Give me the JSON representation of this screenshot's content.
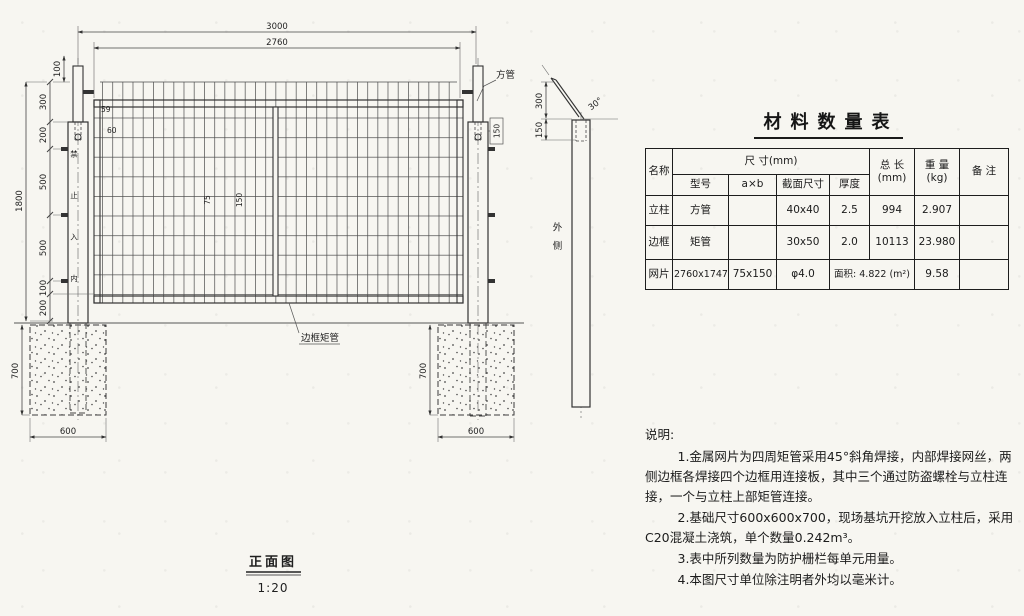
{
  "drawing": {
    "front_view": {
      "title": "正面图",
      "scale": "1:20"
    },
    "dims": {
      "total_width": "3000",
      "panel_width": "2760",
      "top_offset": "100",
      "left_chain": [
        "300",
        "200",
        "500",
        "500",
        "100",
        "200"
      ],
      "post_height": "1800",
      "footing_depth": "700",
      "footing_width": "600",
      "offset_a": "59",
      "offset_b": "60",
      "mesh_cell_w": "75",
      "mesh_cell_h": "150",
      "plate_height": "150",
      "side_arm_length": "300",
      "side_insert_depth": "150",
      "side_angle": "30°"
    },
    "labels": {
      "square_tube": "方管",
      "frame_tube": "边框矩管",
      "outer_side": "外侧",
      "post_marking": "禁止入内"
    }
  },
  "table": {
    "title": "材料数量表",
    "header": {
      "name": "名称",
      "size_group": "尺 寸(mm)",
      "model": "型号",
      "axb": "a×b",
      "section": "截面尺寸",
      "thickness": "厚度",
      "total_1": "总 长",
      "total_2": "(mm)",
      "weight_1": "重 量",
      "weight_2": "(kg)",
      "remark": "备 注"
    },
    "rows": [
      {
        "name": "立柱",
        "model": "方管",
        "axb": "",
        "section": "40x40",
        "thickness": "2.5",
        "total": "994",
        "weight": "2.907",
        "remark": ""
      },
      {
        "name": "边框",
        "model": "矩管",
        "axb": "",
        "section": "30x50",
        "thickness": "2.0",
        "total": "10113",
        "weight": "23.980",
        "remark": ""
      },
      {
        "name": "网片",
        "model": "2760x1747",
        "axb": "75x150",
        "section": "φ4.0",
        "area": "面积: 4.822 (m²)",
        "weight": "9.58",
        "remark": ""
      }
    ]
  },
  "notes": {
    "heading": "说明:",
    "items": [
      "1.金属网片为四周矩管采用45°斜角焊接，内部焊接网丝，两侧边框各焊接四个边框用连接板，其中三个通过防盗螺栓与立柱连接，一个与立柱上部矩管连接。",
      "2.基础尺寸600x600x700，现场基坑开挖放入立柱后，采用C20混凝土浇筑，单个数量0.242m³。",
      "3.表中所列数量为防护栅栏每单元用量。",
      "4.本图尺寸单位除注明者外均以毫米计。"
    ]
  }
}
